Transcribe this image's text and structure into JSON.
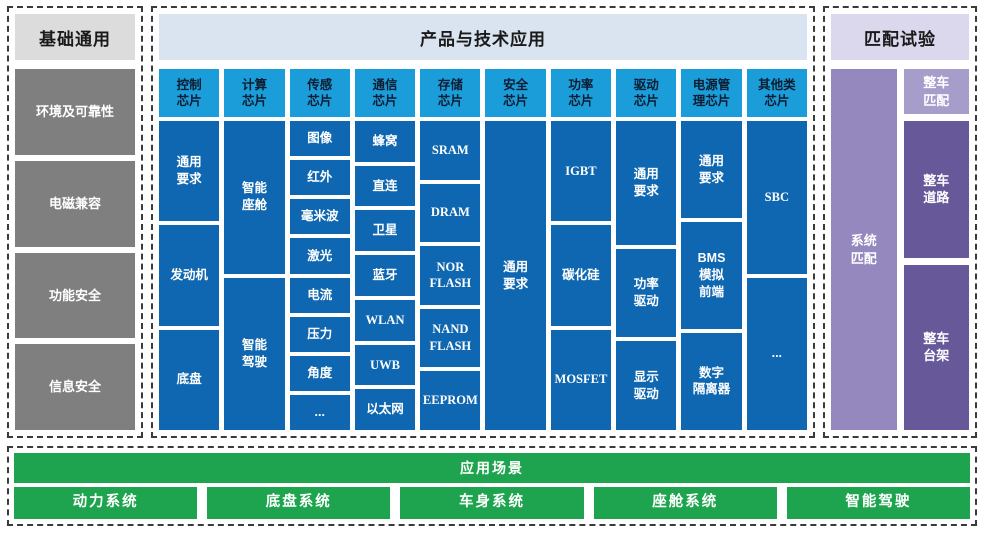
{
  "basic": {
    "title": "基础通用",
    "items": [
      "环境及可靠性",
      "电磁兼容",
      "功能安全",
      "信息安全"
    ]
  },
  "products": {
    "title": "产品与技术应用",
    "columns": [
      {
        "header": "控制\n芯片",
        "cells": [
          "通用\n要求",
          "发动机",
          "底盘"
        ]
      },
      {
        "header": "计算\n芯片",
        "cells": [
          "智能\n座舱",
          "智能\n驾驶"
        ]
      },
      {
        "header": "传感\n芯片",
        "cells": [
          "图像",
          "红外",
          "毫米波",
          "激光",
          "电流",
          "压力",
          "角度",
          "..."
        ]
      },
      {
        "header": "通信\n芯片",
        "cells": [
          "蜂窝",
          "直连",
          "卫星",
          "蓝牙",
          "WLAN",
          "UWB",
          "以太网"
        ]
      },
      {
        "header": "存储\n芯片",
        "cells": [
          "SRAM",
          "DRAM",
          "NOR\nFLASH",
          "NAND\nFLASH",
          "EEPROM"
        ]
      },
      {
        "header": "安全\n芯片",
        "cells": [
          "通用\n要求"
        ]
      },
      {
        "header": "功率\n芯片",
        "cells": [
          "IGBT",
          "碳化硅",
          "MOSFET"
        ]
      },
      {
        "header": "驱动\n芯片",
        "cells": [
          "通用\n要求",
          "功率\n驱动",
          "显示\n驱动"
        ]
      },
      {
        "header": "电源管\n理芯片",
        "cells": [
          "通用\n要求",
          "BMS\n模拟\n前端",
          "数字\n隔离器"
        ]
      },
      {
        "header": "其他类\n芯片",
        "cells": [
          "SBC",
          "..."
        ]
      }
    ]
  },
  "match": {
    "title": "匹配试验",
    "system_cell": "系统\n匹配",
    "vehicle_cells": [
      "整车\n匹配",
      "整车\n道路",
      "整车\n台架"
    ]
  },
  "scenarios": {
    "title": "应用场景",
    "items": [
      "动力系统",
      "底盘系统",
      "车身系统",
      "座舱系统",
      "智能驾驶"
    ]
  },
  "colors": {
    "column_header_blue": "#1b9dd9",
    "cell_blue": "#0e67b0",
    "basic_gray": "#7f7f7f",
    "header_gray": "#dcdcdc",
    "header_blue": "#dae3f0",
    "header_purple": "#dbd7ec",
    "purple_medium": "#9488bf",
    "purple_light": "#a79dcb",
    "purple_dark": "#67589a",
    "green": "#1ea44f"
  }
}
